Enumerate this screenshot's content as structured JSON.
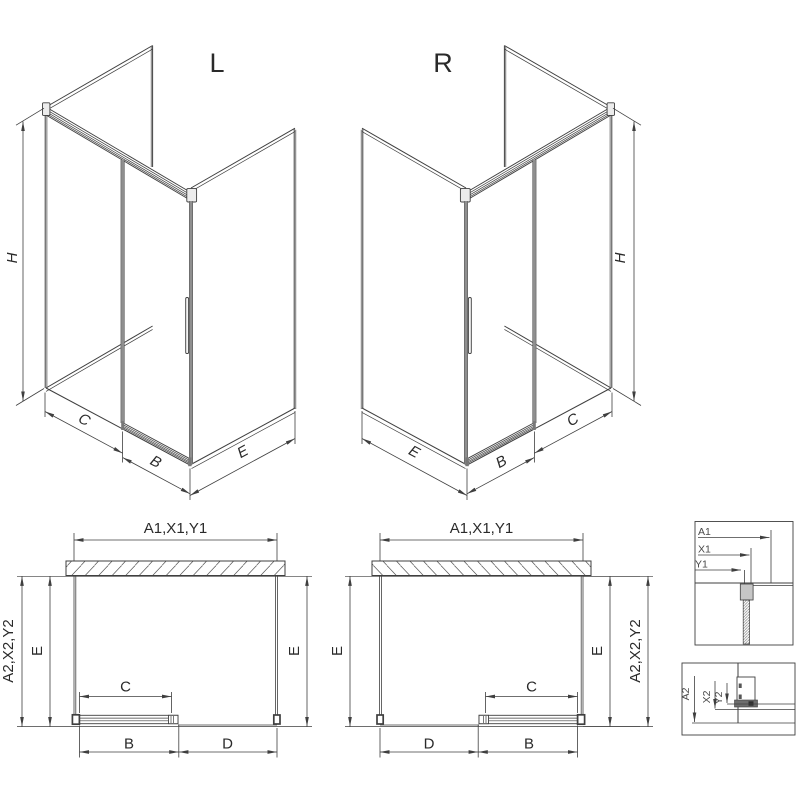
{
  "colors": {
    "line": "#3f3f3f",
    "profile_gray": "#8f8f8f",
    "background": "#ffffff"
  },
  "iso_left": {
    "title": "L",
    "dim_h": "H",
    "dim_c": "C",
    "dim_b": "B",
    "dim_e": "E"
  },
  "iso_right": {
    "title": "R",
    "dim_h": "H",
    "dim_c": "C",
    "dim_b": "B",
    "dim_e": "E"
  },
  "plan_left": {
    "dim_width": "A1,X1,Y1",
    "dim_depth_outer": "A2,X2,Y2",
    "dim_e_left": "E",
    "dim_e_right": "E",
    "dim_c": "C",
    "dim_b": "B",
    "dim_d": "D"
  },
  "plan_right": {
    "dim_width": "A1,X1,Y1",
    "dim_depth_outer": "A2,X2,Y2",
    "dim_e_left": "E",
    "dim_e_right": "E",
    "dim_c": "C",
    "dim_b": "B",
    "dim_d": "D"
  },
  "detail_top": {
    "dim_a1": "A1",
    "dim_x1": "X1",
    "dim_y1": "Y1"
  },
  "detail_bottom": {
    "dim_a2": "A2",
    "dim_x2": "X2",
    "dim_y2": "Y2"
  }
}
